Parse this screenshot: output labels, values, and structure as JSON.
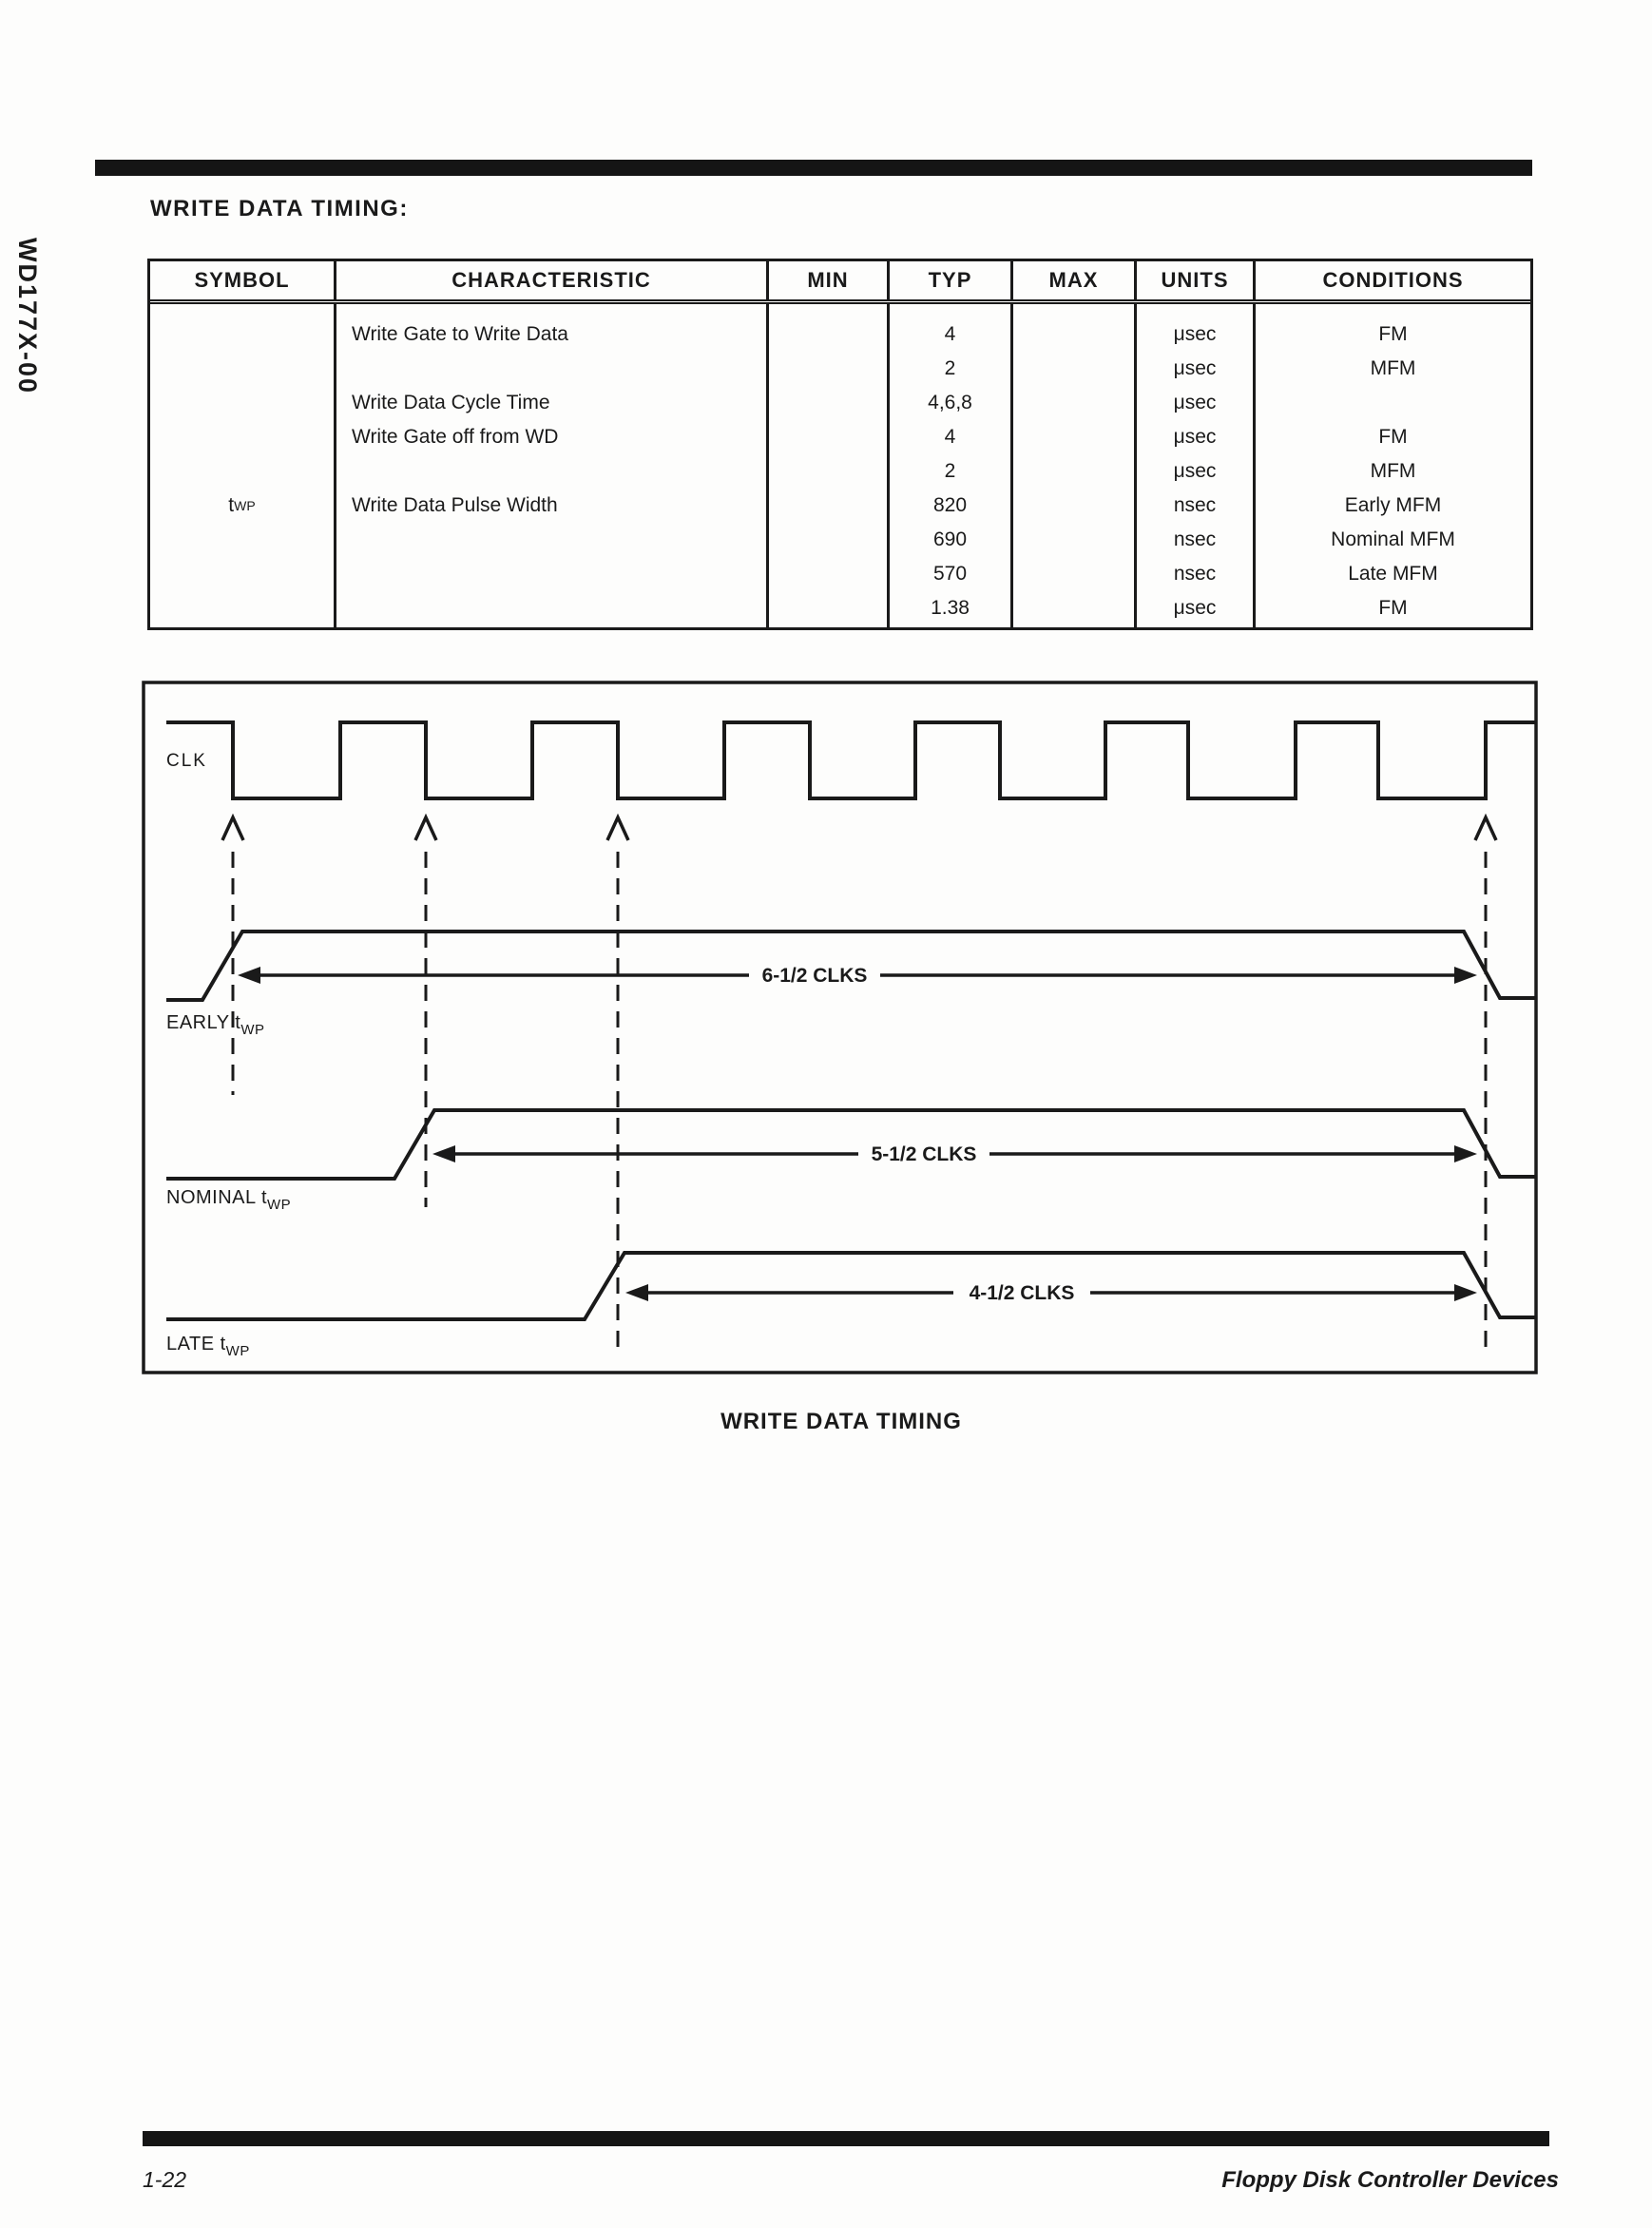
{
  "page": {
    "side_label": "WD177X-00",
    "heading": "WRITE DATA TIMING:",
    "caption": "WRITE DATA TIMING",
    "footer": {
      "page_number": "1-22",
      "title": "Floppy Disk Controller Devices"
    }
  },
  "table": {
    "headers": [
      "SYMBOL",
      "CHARACTERISTIC",
      "MIN",
      "TYP",
      "MAX",
      "UNITS",
      "CONDITIONS"
    ],
    "rows": [
      {
        "symbol_main": "",
        "symbol_sub": "",
        "characteristic": "Write Gate to Write Data",
        "min": "",
        "typ": "4",
        "max": "",
        "units": "μsec",
        "conditions": "FM"
      },
      {
        "symbol_main": "",
        "symbol_sub": "",
        "characteristic": "",
        "min": "",
        "typ": "2",
        "max": "",
        "units": "μsec",
        "conditions": "MFM"
      },
      {
        "symbol_main": "",
        "symbol_sub": "",
        "characteristic": "Write Data Cycle Time",
        "min": "",
        "typ": "4,6,8",
        "max": "",
        "units": "μsec",
        "conditions": ""
      },
      {
        "symbol_main": "",
        "symbol_sub": "",
        "characteristic": "Write Gate off from WD",
        "min": "",
        "typ": "4",
        "max": "",
        "units": "μsec",
        "conditions": "FM"
      },
      {
        "symbol_main": "",
        "symbol_sub": "",
        "characteristic": "",
        "min": "",
        "typ": "2",
        "max": "",
        "units": "μsec",
        "conditions": "MFM"
      },
      {
        "symbol_main": "t",
        "symbol_sub": "WP",
        "characteristic": "Write Data Pulse Width",
        "min": "",
        "typ": "820",
        "max": "",
        "units": "nsec",
        "conditions": "Early MFM"
      },
      {
        "symbol_main": "",
        "symbol_sub": "",
        "characteristic": "",
        "min": "",
        "typ": "690",
        "max": "",
        "units": "nsec",
        "conditions": "Nominal MFM"
      },
      {
        "symbol_main": "",
        "symbol_sub": "",
        "characteristic": "",
        "min": "",
        "typ": "570",
        "max": "",
        "units": "nsec",
        "conditions": "Late MFM"
      },
      {
        "symbol_main": "",
        "symbol_sub": "",
        "characteristic": "",
        "min": "",
        "typ": "1.38",
        "max": "",
        "units": "μsec",
        "conditions": "FM"
      }
    ]
  },
  "diagram": {
    "clk_label": "CLK",
    "waveforms": [
      {
        "label_prefix": "EARLY t",
        "label_sub": "WP",
        "duration_label": "6-1/2 CLKS"
      },
      {
        "label_prefix": "NOMINAL t",
        "label_sub": "WP",
        "duration_label": "5-1/2 CLKS"
      },
      {
        "label_prefix": "LATE t",
        "label_sub": "WP",
        "duration_label": "4-1/2 CLKS"
      }
    ]
  }
}
